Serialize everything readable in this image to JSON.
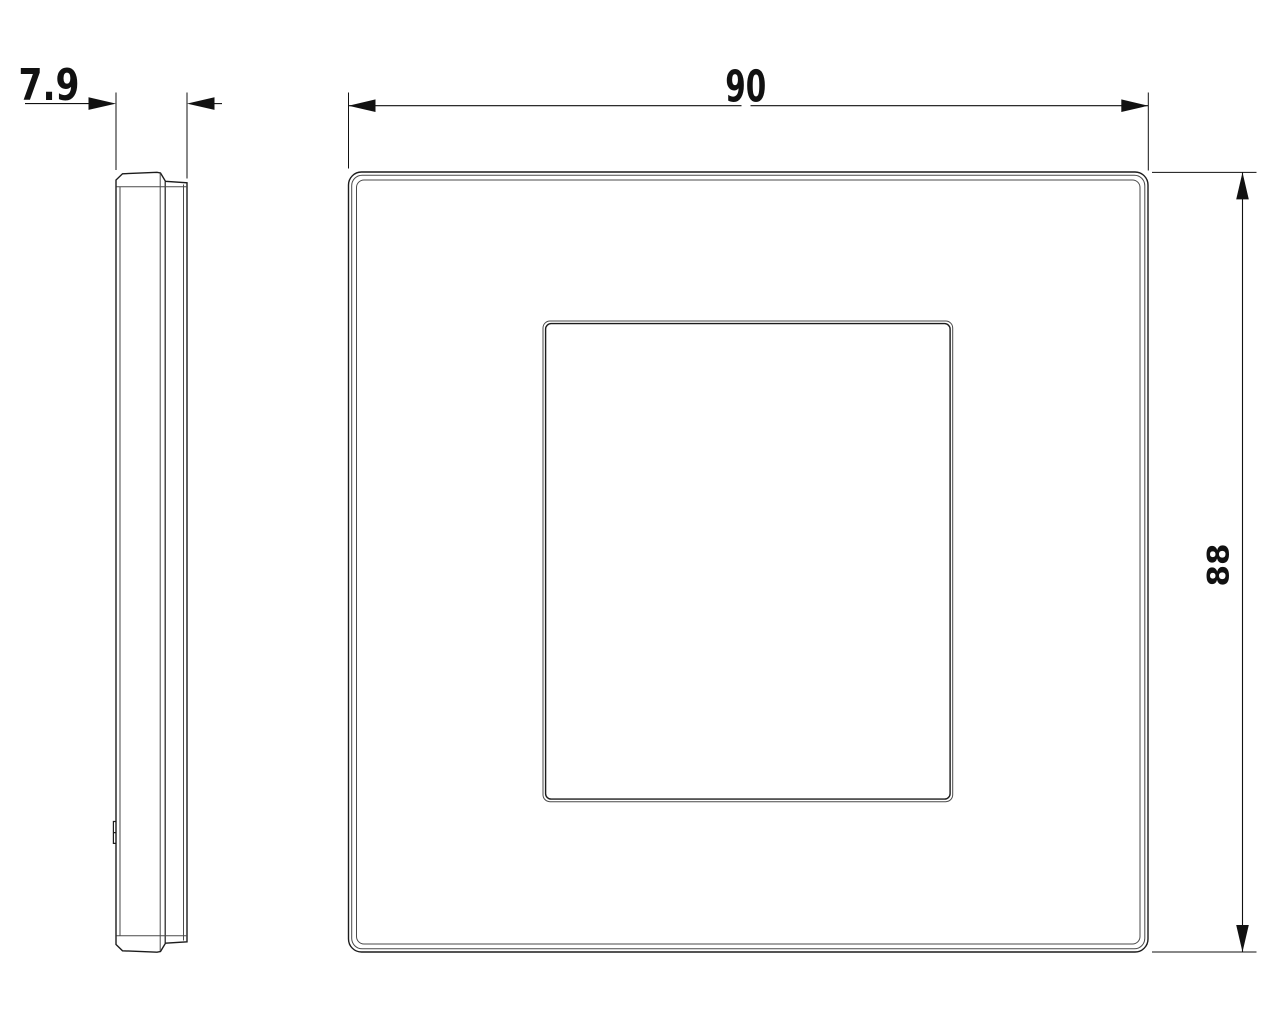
{
  "drawing": {
    "background_color": "#ffffff",
    "outline_color": "#1c1c1c",
    "secondary_edge_color": "#4a4a4a",
    "dimension_color": "#111111",
    "dimensions": {
      "thickness": {
        "value": "7.9"
      },
      "width": {
        "value": "90"
      },
      "height": {
        "value": "88"
      }
    }
  }
}
